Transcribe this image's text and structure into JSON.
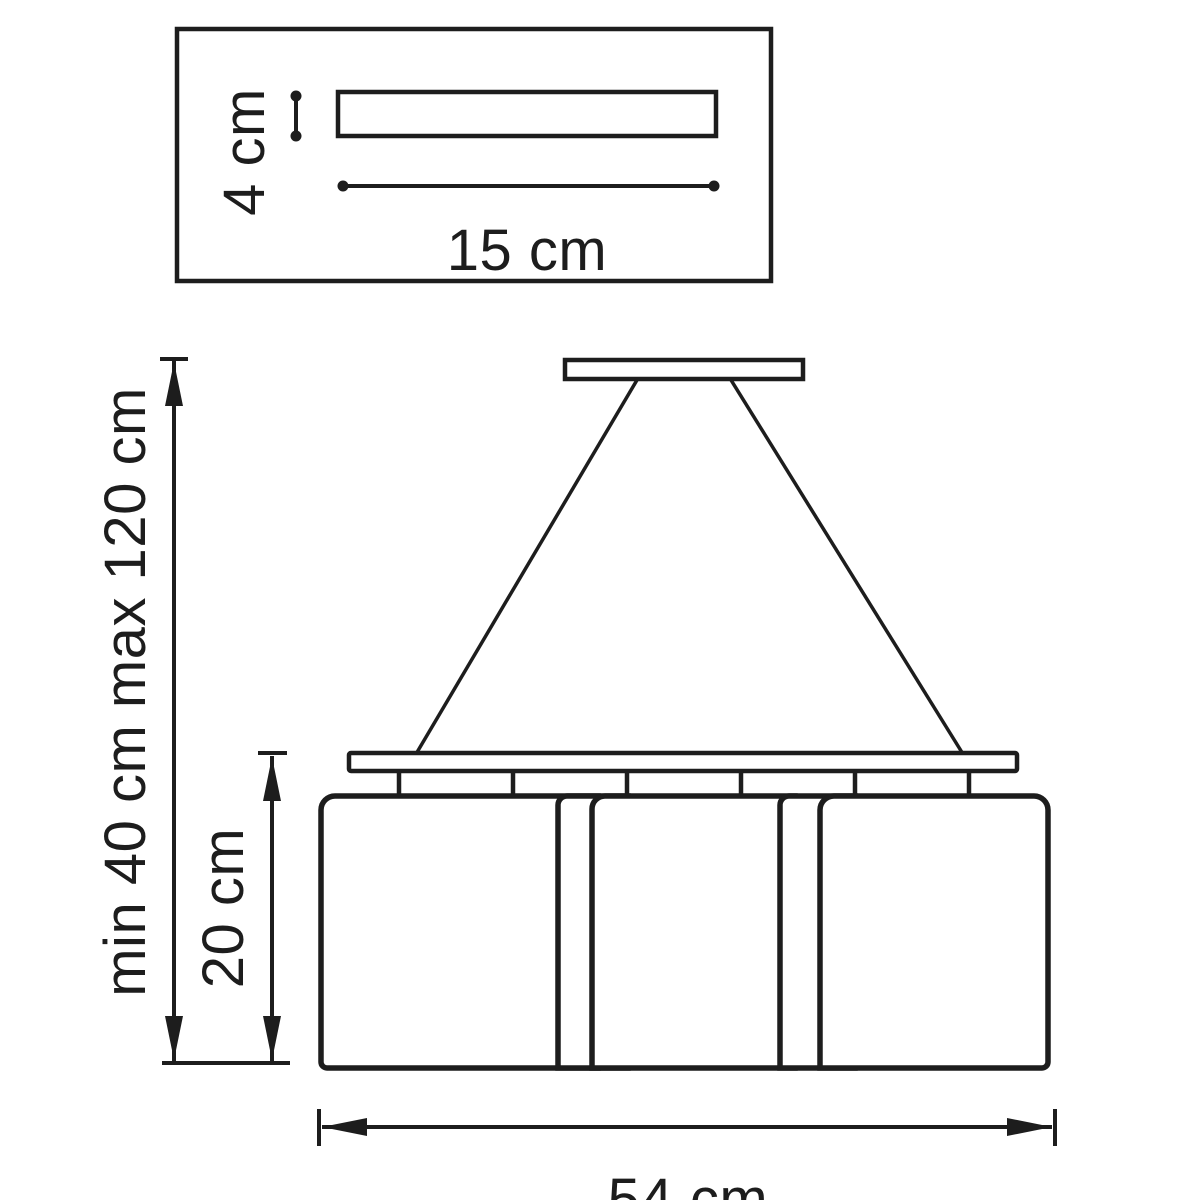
{
  "diagram": {
    "type": "pendant-lamp-dimension-drawing",
    "colors": {
      "line": "#1d1d1d",
      "text": "#1d1d1d",
      "background": "#ffffff"
    },
    "canopy_detail": {
      "height_label": "4 cm",
      "width_label": "15 cm"
    },
    "fixture": {
      "suspension_label": "min 40 cm max 120 cm",
      "shade_height_label": "20 cm",
      "overall_width_label": "54 cm"
    }
  }
}
